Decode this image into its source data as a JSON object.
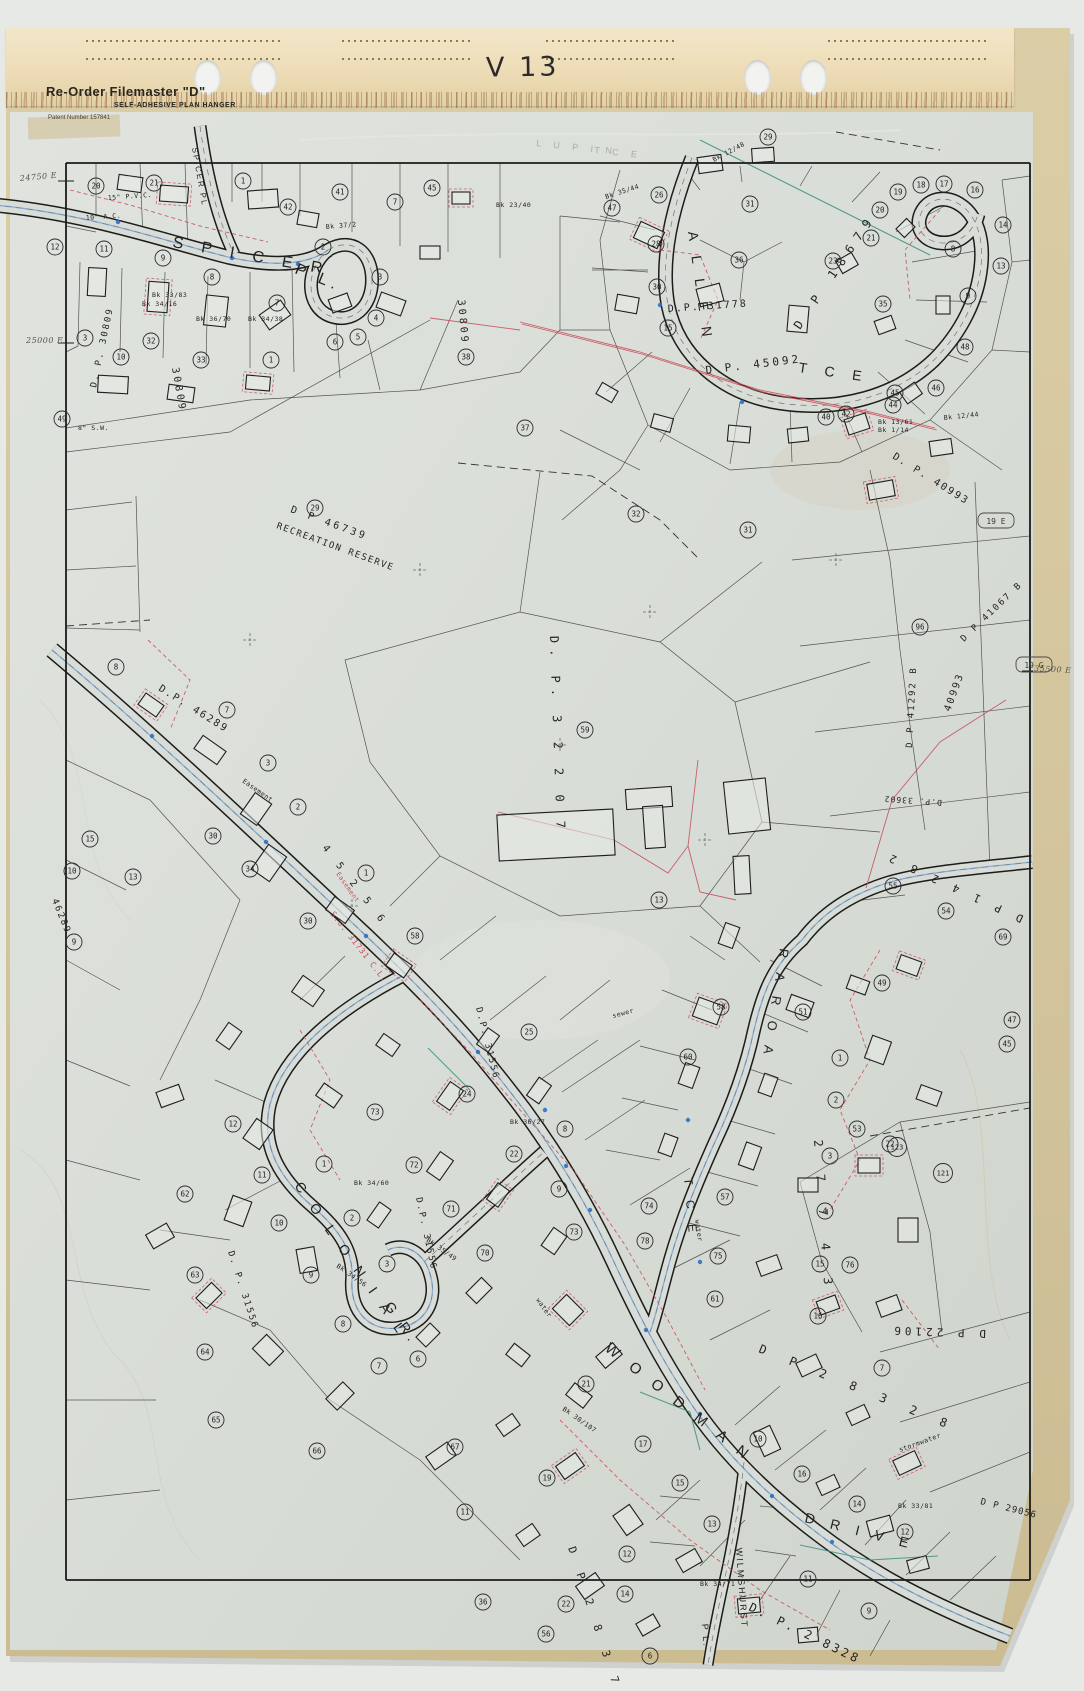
{
  "scan": {
    "sheet_code": "V 13"
  },
  "hanger": {
    "brand": "Re-Order Filemaster \"D\"",
    "subtitle": "SELF-ADHESIVE PLAN HANGER",
    "patent": "Patent Number 157841"
  },
  "colors": {
    "paper": "#d9ddd7",
    "hanger": "#eddcb6",
    "backing": "#d2c39b",
    "ink": "#1c1c1b",
    "red": "#c9505a",
    "blue": "#5b8cc8",
    "green": "#3e8f7e"
  },
  "map": {
    "street_labels": [
      {
        "t": "S P I C E R",
        "x": 172,
        "y": 247,
        "r": 10,
        "s": 16,
        "ls": 7
      },
      {
        "t": "P L.",
        "x": 294,
        "y": 273,
        "r": 22,
        "s": 16,
        "ls": 5
      },
      {
        "t": "SPICER PL",
        "x": 192,
        "y": 148,
        "r": 80,
        "s": 8,
        "ls": 2
      },
      {
        "t": "A L L E N",
        "x": 688,
        "y": 232,
        "r": 82,
        "s": 14,
        "ls": 6
      },
      {
        "t": "T C E",
        "x": 798,
        "y": 372,
        "r": 8,
        "s": 14,
        "ls": 7
      },
      {
        "t": "L U P I N",
        "x": 536,
        "y": 146,
        "r": 6,
        "s": 9,
        "ls": 5,
        "c": "faint"
      },
      {
        "t": "T C E",
        "x": 594,
        "y": 153,
        "r": 6,
        "s": 9,
        "ls": 5,
        "c": "faint"
      },
      {
        "t": "C O L O N I A L",
        "x": 294,
        "y": 1186,
        "r": 55,
        "s": 14,
        "ls": 6
      },
      {
        "t": "G R.",
        "x": 384,
        "y": 1306,
        "r": 55,
        "s": 14,
        "ls": 5
      },
      {
        "t": "R A R O A",
        "x": 780,
        "y": 948,
        "r": 99,
        "s": 13,
        "ls": 6
      },
      {
        "t": "T C E",
        "x": 684,
        "y": 1178,
        "r": 85,
        "s": 12,
        "ls": 6
      },
      {
        "t": "W O O D M A N",
        "x": 604,
        "y": 1350,
        "r": 38,
        "s": 15,
        "ls": 6
      },
      {
        "t": "D R I V E",
        "x": 804,
        "y": 1522,
        "r": 14,
        "s": 14,
        "ls": 6
      },
      {
        "t": "WILMSHURST",
        "x": 736,
        "y": 1548,
        "r": 86,
        "s": 9,
        "ls": 2
      },
      {
        "t": "P L.",
        "x": 702,
        "y": 1624,
        "r": 86,
        "s": 9,
        "ls": 2
      }
    ],
    "plan_labels": [
      {
        "t": "D.P. 31778",
        "x": 668,
        "y": 312,
        "r": -4,
        "s": 10,
        "ls": 2
      },
      {
        "t": "D.P. 45092",
        "x": 706,
        "y": 374,
        "r": -7,
        "s": 11,
        "ls": 3
      },
      {
        "t": "D. P. 30809",
        "x": 96,
        "y": 388,
        "r": -78,
        "s": 9,
        "ls": 2
      },
      {
        "t": "30809",
        "x": 458,
        "y": 300,
        "r": 85,
        "s": 10,
        "ls": 3
      },
      {
        "t": "30809",
        "x": 172,
        "y": 368,
        "r": 80,
        "s": 10,
        "ls": 3
      },
      {
        "t": "D P 46739",
        "x": 290,
        "y": 512,
        "r": 20,
        "s": 10,
        "ls": 3
      },
      {
        "t": "RECREATION RESERVE",
        "x": 276,
        "y": 528,
        "r": 20,
        "s": 9,
        "ls": 1.5
      },
      {
        "t": "D. P. 3 2 2 0 7",
        "x": 550,
        "y": 636,
        "r": 88,
        "s": 12,
        "ls": 6
      },
      {
        "t": "D.P. 46289",
        "x": 158,
        "y": 690,
        "r": 32,
        "s": 10,
        "ls": 2
      },
      {
        "t": "46289",
        "x": 52,
        "y": 900,
        "r": 68,
        "s": 9,
        "ls": 2
      },
      {
        "t": "4 5 2 5 6",
        "x": 322,
        "y": 848,
        "r": 52,
        "s": 10,
        "ls": 5
      },
      {
        "t": "S.O. 31731  C.L.",
        "x": 330,
        "y": 914,
        "r": 52,
        "s": 8,
        "ls": 1,
        "c": "red"
      },
      {
        "t": "D.P. 31556",
        "x": 476,
        "y": 1008,
        "r": 76,
        "s": 9,
        "ls": 2
      },
      {
        "t": "D.P. 31556",
        "x": 416,
        "y": 1198,
        "r": 78,
        "s": 9,
        "ls": 2
      },
      {
        "t": "D. P. 31556",
        "x": 228,
        "y": 1252,
        "r": 72,
        "s": 9,
        "ls": 2
      },
      {
        "t": "D. P. 40993",
        "x": 892,
        "y": 458,
        "r": 32,
        "s": 10,
        "ls": 2
      },
      {
        "t": "D P 41067 B",
        "x": 964,
        "y": 642,
        "r": -44,
        "s": 9,
        "ls": 2
      },
      {
        "t": "40993",
        "x": 950,
        "y": 712,
        "r": -70,
        "s": 10,
        "ls": 2
      },
      {
        "t": "D P 41292 B",
        "x": 912,
        "y": 748,
        "r": -87,
        "s": 9,
        "ls": 2
      },
      {
        "t": "D.P. 33602",
        "x": 942,
        "y": 800,
        "r": 184,
        "s": 8,
        "ls": 1
      },
      {
        "t": "D P 1 4 2 8 2",
        "x": 1024,
        "y": 916,
        "r": 205,
        "s": 11,
        "ls": 5
      },
      {
        "t": "D P 18679",
        "x": 800,
        "y": 330,
        "r": -56,
        "s": 12,
        "ls": 8
      },
      {
        "t": "D P 22106",
        "x": 986,
        "y": 1330,
        "r": 182,
        "s": 11,
        "ls": 4
      },
      {
        "t": "D P 29056",
        "x": 980,
        "y": 1504,
        "r": 14,
        "s": 9,
        "ls": 1
      },
      {
        "t": "D P 2 8 3 2 8",
        "x": 758,
        "y": 1352,
        "r": 22,
        "s": 12,
        "ls": 9
      },
      {
        "t": "2 7 7 4 3",
        "x": 814,
        "y": 1140,
        "r": 86,
        "s": 12,
        "ls": 10
      },
      {
        "t": "D P 2 8 3 7 1",
        "x": 568,
        "y": 1548,
        "r": 72,
        "s": 11,
        "ls": 7
      },
      {
        "t": "D. P. 2 8328",
        "x": 748,
        "y": 1610,
        "r": 26,
        "s": 12,
        "ls": 3
      }
    ],
    "small_labels": [
      {
        "t": "Bk 33/83",
        "x": 152,
        "y": 297,
        "r": 0
      },
      {
        "t": "Bk 34/16",
        "x": 142,
        "y": 306,
        "r": 0
      },
      {
        "t": "Bk 36/70",
        "x": 196,
        "y": 321,
        "r": 0
      },
      {
        "t": "Bk 34/38",
        "x": 248,
        "y": 321,
        "r": 0
      },
      {
        "t": "Bk 37/2",
        "x": 326,
        "y": 229,
        "r": -5
      },
      {
        "t": "Bk 35/44",
        "x": 606,
        "y": 199,
        "r": -18
      },
      {
        "t": "Bk 12/48",
        "x": 714,
        "y": 162,
        "r": -28
      },
      {
        "t": "Bk 23/40",
        "x": 496,
        "y": 207,
        "r": 0
      },
      {
        "t": "Bk 13/61",
        "x": 878,
        "y": 424,
        "r": 0
      },
      {
        "t": "Bk 1/14",
        "x": 878,
        "y": 432,
        "r": 0
      },
      {
        "t": "Bk 12/44",
        "x": 944,
        "y": 420,
        "r": -6
      },
      {
        "t": "Bk 34/60",
        "x": 354,
        "y": 1185,
        "r": 0
      },
      {
        "t": "Bk 36/27",
        "x": 510,
        "y": 1124,
        "r": 0
      },
      {
        "t": "Bk 35/49",
        "x": 426,
        "y": 1241,
        "r": 35
      },
      {
        "t": "Bk 34/56",
        "x": 336,
        "y": 1267,
        "r": 35
      },
      {
        "t": "Bk 30/107",
        "x": 562,
        "y": 1410,
        "r": 35
      },
      {
        "t": "Bk 33/81",
        "x": 898,
        "y": 1508,
        "r": 0
      },
      {
        "t": "Bk 34/71",
        "x": 700,
        "y": 1586,
        "r": 0
      },
      {
        "t": "sewer",
        "x": 613,
        "y": 1018,
        "r": -15
      },
      {
        "t": "water",
        "x": 695,
        "y": 1220,
        "r": 82
      },
      {
        "t": "stormwater",
        "x": 900,
        "y": 1452,
        "r": -20
      },
      {
        "t": "water",
        "x": 536,
        "y": 1300,
        "r": 55
      },
      {
        "t": "Easement",
        "x": 242,
        "y": 782,
        "r": 35
      },
      {
        "t": "Easement",
        "x": 336,
        "y": 874,
        "r": 55,
        "c": "red"
      },
      {
        "t": "10\" A.C.",
        "x": 86,
        "y": 220,
        "r": -4
      },
      {
        "t": "8\" S.W.",
        "x": 78,
        "y": 430,
        "r": 0
      },
      {
        "t": "15\" P.V.C.",
        "x": 108,
        "y": 200,
        "r": -4
      }
    ],
    "edge_labels": [
      {
        "t": "24750 E",
        "x": 20,
        "y": 181,
        "r": -5
      },
      {
        "t": "25000 E",
        "x": 26,
        "y": 343,
        "r": 0
      },
      {
        "t": "35500 E",
        "x": 1034,
        "y": 671,
        "r": 3
      }
    ],
    "boxed_labels": [
      {
        "t": "19 E",
        "x": 982,
        "y": 524
      },
      {
        "t": "19 G",
        "x": 1020,
        "y": 668
      }
    ],
    "lot_markers": [
      [
        20,
        96,
        186
      ],
      [
        21,
        154,
        183
      ],
      [
        1,
        243,
        181
      ],
      [
        42,
        288,
        207
      ],
      [
        41,
        340,
        192
      ],
      [
        7,
        395,
        202
      ],
      [
        45,
        432,
        188
      ],
      [
        12,
        55,
        247
      ],
      [
        11,
        104,
        249
      ],
      [
        9,
        163,
        258
      ],
      [
        8,
        212,
        277
      ],
      [
        2,
        323,
        247
      ],
      [
        7,
        277,
        303
      ],
      [
        3,
        380,
        277
      ],
      [
        4,
        376,
        318
      ],
      [
        5,
        358,
        337
      ],
      [
        6,
        335,
        342
      ],
      [
        38,
        466,
        357
      ],
      [
        3,
        85,
        338
      ],
      [
        32,
        151,
        341
      ],
      [
        10,
        121,
        357
      ],
      [
        33,
        201,
        360
      ],
      [
        1,
        271,
        360
      ],
      [
        49,
        62,
        419
      ],
      [
        29,
        768,
        137
      ],
      [
        26,
        659,
        195
      ],
      [
        47,
        612,
        208
      ],
      [
        31,
        750,
        204
      ],
      [
        19,
        898,
        192
      ],
      [
        18,
        921,
        185
      ],
      [
        17,
        944,
        184
      ],
      [
        16,
        975,
        190
      ],
      [
        20,
        880,
        210
      ],
      [
        21,
        871,
        238
      ],
      [
        28,
        656,
        244
      ],
      [
        30,
        657,
        287
      ],
      [
        36,
        739,
        260
      ],
      [
        23,
        833,
        261
      ],
      [
        35,
        883,
        304
      ],
      [
        15,
        668,
        328
      ],
      [
        14,
        1003,
        225
      ],
      [
        13,
        1001,
        266
      ],
      [
        48,
        965,
        347
      ],
      [
        46,
        936,
        388
      ],
      [
        45,
        895,
        393
      ],
      [
        44,
        893,
        405
      ],
      [
        42,
        846,
        414
      ],
      [
        40,
        826,
        417
      ],
      [
        37,
        525,
        428
      ],
      [
        8,
        953,
        249
      ],
      [
        9,
        968,
        296
      ],
      [
        32,
        636,
        514
      ],
      [
        31,
        748,
        530
      ],
      [
        29,
        315,
        508
      ],
      [
        7,
        227,
        710
      ],
      [
        59,
        585,
        730
      ],
      [
        96,
        920,
        627
      ],
      [
        8,
        116,
        667
      ],
      [
        3,
        268,
        763
      ],
      [
        2,
        298,
        807
      ],
      [
        30,
        213,
        836
      ],
      [
        34,
        250,
        869
      ],
      [
        15,
        90,
        839
      ],
      [
        13,
        133,
        877
      ],
      [
        10,
        72,
        871
      ],
      [
        9,
        74,
        942
      ],
      [
        30,
        308,
        921
      ],
      [
        58,
        415,
        936
      ],
      [
        1,
        366,
        873
      ],
      [
        73,
        375,
        1112
      ],
      [
        72,
        414,
        1165
      ],
      [
        71,
        451,
        1209
      ],
      [
        70,
        485,
        1253
      ],
      [
        24,
        467,
        1094
      ],
      [
        25,
        529,
        1032
      ],
      [
        22,
        514,
        1154
      ],
      [
        8,
        565,
        1129
      ],
      [
        9,
        559,
        1189
      ],
      [
        11,
        262,
        1175
      ],
      [
        12,
        233,
        1124
      ],
      [
        1,
        324,
        1164
      ],
      [
        62,
        185,
        1194
      ],
      [
        10,
        279,
        1223
      ],
      [
        63,
        195,
        1275
      ],
      [
        9,
        311,
        1275
      ],
      [
        8,
        343,
        1324
      ],
      [
        64,
        205,
        1352
      ],
      [
        7,
        379,
        1366
      ],
      [
        65,
        216,
        1420
      ],
      [
        66,
        317,
        1451
      ],
      [
        6,
        418,
        1359
      ],
      [
        3,
        387,
        1264
      ],
      [
        2,
        352,
        1218
      ],
      [
        13,
        659,
        900
      ],
      [
        58,
        721,
        1007
      ],
      [
        51,
        803,
        1012
      ],
      [
        49,
        882,
        983
      ],
      [
        54,
        946,
        911
      ],
      [
        55,
        893,
        886
      ],
      [
        69,
        1003,
        937
      ],
      [
        47,
        1012,
        1020
      ],
      [
        45,
        1007,
        1044
      ],
      [
        60,
        688,
        1057
      ],
      [
        53,
        857,
        1129
      ],
      [
        22,
        890,
        1144
      ],
      [
        1,
        840,
        1058
      ],
      [
        2,
        836,
        1100
      ],
      [
        123,
        897,
        1147
      ],
      [
        121,
        943,
        1173
      ],
      [
        3,
        830,
        1156
      ],
      [
        4,
        825,
        1211
      ],
      [
        57,
        725,
        1197
      ],
      [
        75,
        718,
        1256
      ],
      [
        15,
        820,
        1264
      ],
      [
        76,
        850,
        1265
      ],
      [
        61,
        715,
        1299
      ],
      [
        16,
        818,
        1316
      ],
      [
        7,
        882,
        1368
      ],
      [
        74,
        649,
        1206
      ],
      [
        73,
        574,
        1232
      ],
      [
        78,
        645,
        1241
      ],
      [
        21,
        586,
        1384
      ],
      [
        17,
        643,
        1444
      ],
      [
        19,
        547,
        1478
      ],
      [
        10,
        758,
        1439
      ],
      [
        16,
        802,
        1474
      ],
      [
        15,
        680,
        1483
      ],
      [
        13,
        712,
        1524
      ],
      [
        14,
        857,
        1504
      ],
      [
        12,
        905,
        1532
      ],
      [
        11,
        808,
        1579
      ],
      [
        9,
        869,
        1611
      ],
      [
        22,
        566,
        1604
      ],
      [
        56,
        546,
        1634
      ],
      [
        14,
        625,
        1594
      ],
      [
        12,
        627,
        1554
      ],
      [
        6,
        650,
        1656
      ],
      [
        67,
        455,
        1447
      ],
      [
        11,
        465,
        1512
      ],
      [
        36,
        483,
        1602
      ]
    ]
  }
}
